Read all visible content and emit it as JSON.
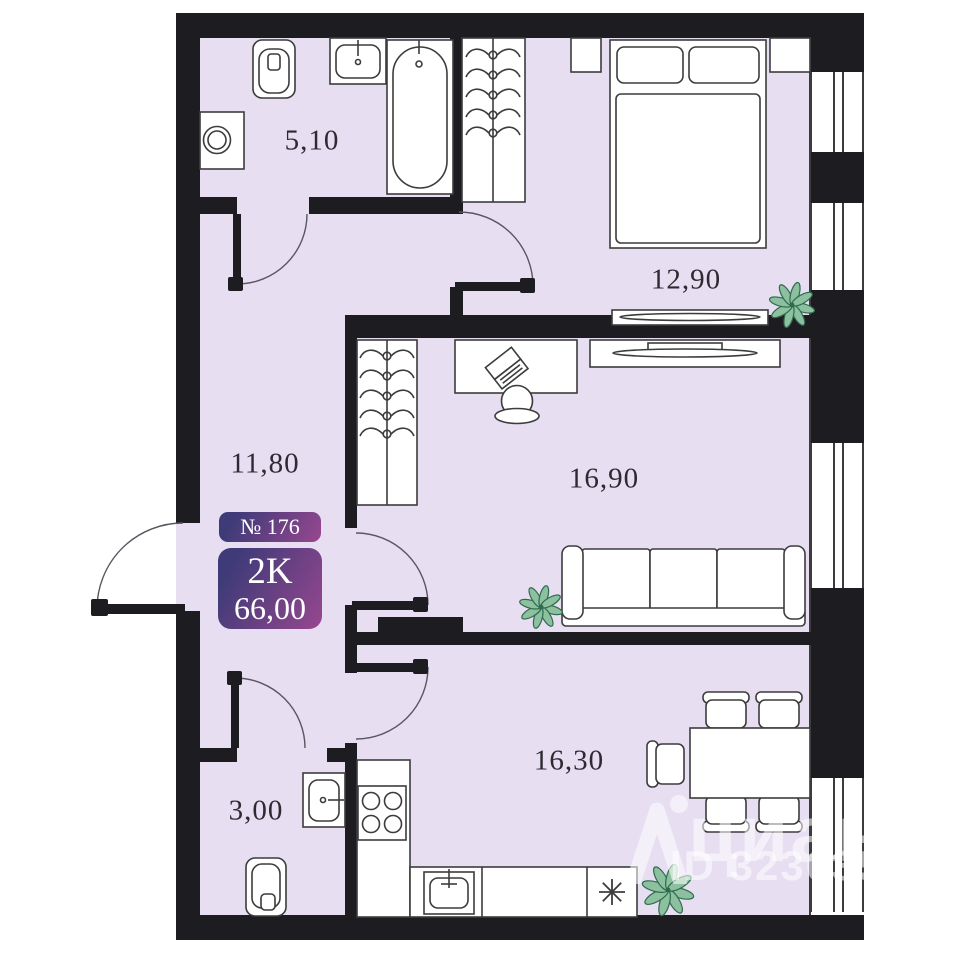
{
  "plan": {
    "badge": {
      "number": "№ 176",
      "rooms_type": "2K",
      "total_area": "66,00"
    },
    "rooms": [
      {
        "id": "bathroom",
        "area": "5,10"
      },
      {
        "id": "bedroom",
        "area": "12,90"
      },
      {
        "id": "hallway",
        "area": "11,80"
      },
      {
        "id": "living-room",
        "area": "16,90"
      },
      {
        "id": "wc",
        "area": "3,00"
      },
      {
        "id": "kitchen-dining",
        "area": "16,30"
      }
    ],
    "watermark": {
      "brand": "циан",
      "listing_id": "ID 323035"
    },
    "icons": {
      "fridge": "snowflake-asterisk",
      "plant": "potted-plant-top-view",
      "wardrobe": "clothes-hangers",
      "logo": "cian-pin"
    }
  },
  "colors": {
    "wall": "#1d1c20",
    "floor": "#e7def2",
    "furniture_stroke": "#3c3c3c",
    "plant_fill": "#8cc09e",
    "plant_stroke": "#2f6b4f",
    "badge_gradient_start": "#3f3b78",
    "badge_gradient_end": "#97478f",
    "label_text": "#2d2b31",
    "watermark_text": "rgba(255,255,255,0.55)"
  }
}
